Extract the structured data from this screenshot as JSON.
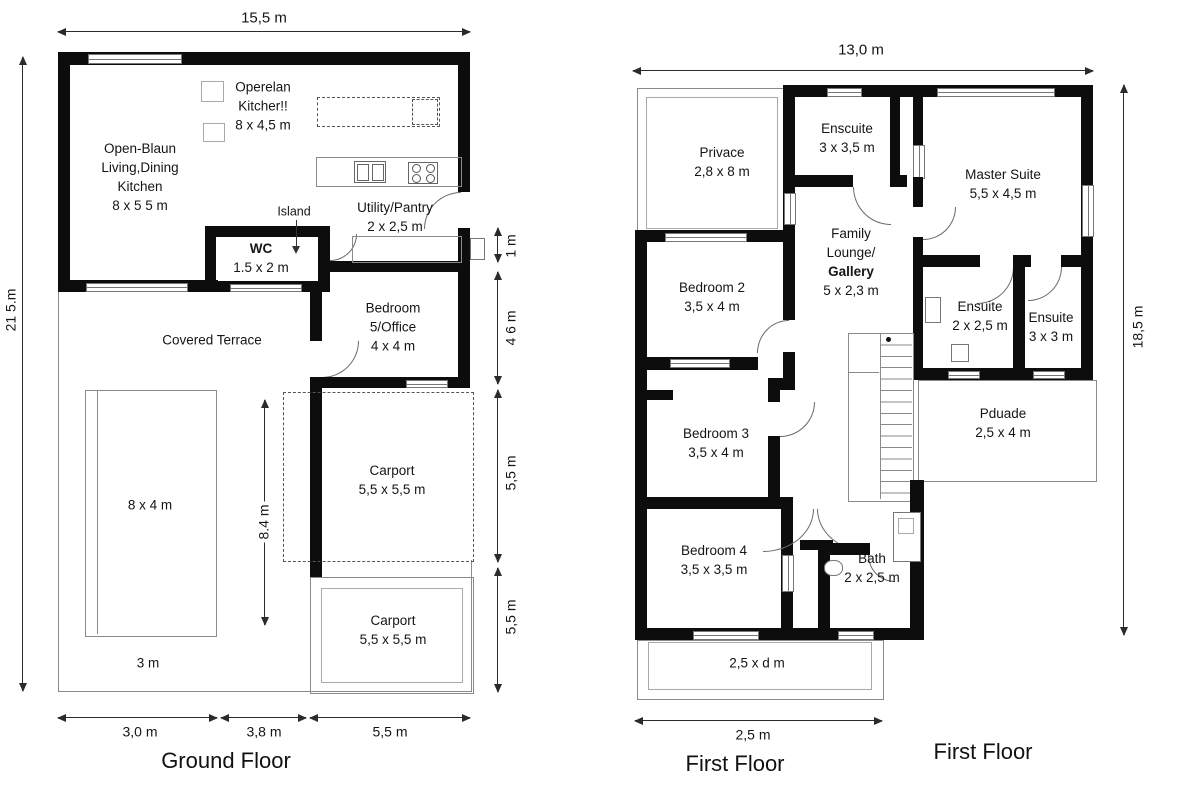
{
  "ground": {
    "title": "Ground Floor",
    "dims": {
      "top": "15,5 m",
      "left": "21 5.m",
      "right1": "1 m",
      "right2": "4 6 m",
      "right3": "5,5 m",
      "right4": "5,5 m",
      "inner": "8.4 m",
      "bottom1": "3,0 m",
      "bottom2": "3,8 m",
      "bottom3": "5,5 m"
    },
    "living": {
      "l1": "Open-Blaun",
      "l2": "Living,Dining",
      "l3": "Kitchen",
      "l4": "8 x 5 5 m"
    },
    "note": {
      "l1": "Operelan",
      "l2": "Kitcher!!",
      "l3": "8 x 4,5 m"
    },
    "island": "Island",
    "wc": {
      "name": "WC",
      "size": "1.5 x 2 m"
    },
    "utility": {
      "name": "Utility/Pantry",
      "size": "2 x 2,5 m"
    },
    "bedroom5": {
      "l1": "Bedroom",
      "l2": "5/Office",
      "l3": "4 x 4 m"
    },
    "terrace": "Covered Terrace",
    "pool": "8 x 4 m",
    "pool_note": "3 m",
    "carport1": {
      "name": "Carport",
      "size": "5,5 x 5,5 m"
    },
    "carport2": {
      "name": "Carport",
      "size": "5,5 x 5,5 m"
    }
  },
  "first": {
    "title": "First Floor",
    "title2": "First Floor",
    "dims": {
      "top": "13,0 m",
      "right": "18,5 m",
      "bottom": "2,5 m"
    },
    "privace": {
      "name": "Privace",
      "size": "2,8 x 8 m"
    },
    "enscuite": {
      "name": "Enscuite",
      "size": "3 x 3,5 m"
    },
    "master": {
      "name": "Master Suite",
      "size": "5,5 x 4,5 m"
    },
    "family": {
      "l1": "Family",
      "l2": "Lounge/",
      "l3": "Gallery",
      "l4": "5 x 2,3 m"
    },
    "bedroom2": {
      "name": "Bedroom 2",
      "size": "3,5 x 4 m"
    },
    "ensuite1": {
      "name": "Ensuite",
      "size": "2 x 2,5 m"
    },
    "ensuite2": {
      "name": "Ensuite",
      "size": "3 x 3 m"
    },
    "pduade": {
      "name": "Pduade",
      "size": "2,5 x 4 m"
    },
    "bedroom3": {
      "name": "Bedroom 3",
      "size": "3,5 x 4 m"
    },
    "bedroom4": {
      "name": "Bedroom 4",
      "size": "3,5 x 3,5 m"
    },
    "bath": {
      "name": "Bath",
      "size": "2 x 2,5 m"
    },
    "balcony": "2,5 x d m"
  }
}
